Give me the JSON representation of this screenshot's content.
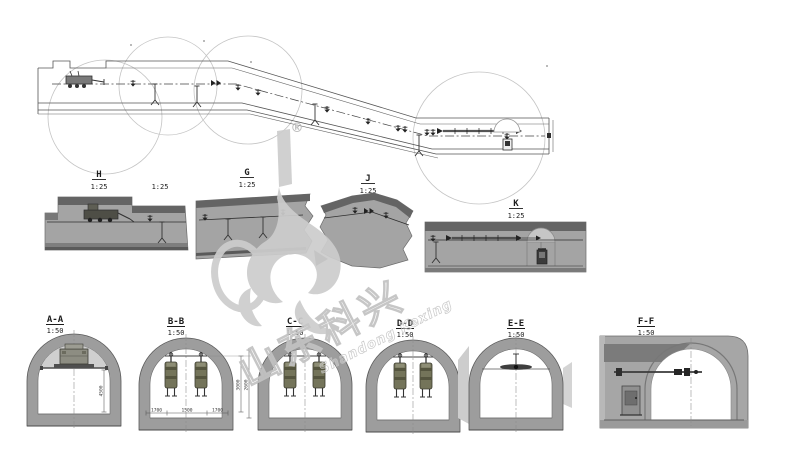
{
  "watermark": {
    "registered": "®",
    "cn": "山东科兴",
    "en": "Shandong Kexing"
  },
  "details": {
    "h": {
      "id": "H",
      "scale": "1:25"
    },
    "h_right_scale": "1:25",
    "g": {
      "id": "G",
      "scale": "1:25"
    },
    "j": {
      "id": "J",
      "scale": "1:25"
    },
    "k": {
      "id": "K",
      "scale": "1:25"
    }
  },
  "sections": {
    "aa": {
      "id": "A-A",
      "scale": "1:50",
      "dim_height": "4500"
    },
    "bb": {
      "id": "B-B",
      "scale": "1:50",
      "dim_right_inner": "3000",
      "dim_right_outer": "2600",
      "dim_bottom": [
        "1700",
        "1500",
        "1700"
      ]
    },
    "cc": {
      "id": "C-C",
      "scale": "1:50"
    },
    "dd": {
      "id": "D-D",
      "scale": "1:50"
    },
    "ee": {
      "id": "E-E",
      "scale": "1:50"
    },
    "ff": {
      "id": "F-F",
      "scale": "1:50"
    }
  },
  "colors": {
    "section_body": "#a4a4a4",
    "section_top_band": "#646464",
    "tunnel_lining": "#9d9d9d",
    "equipment_olive": "#74745a",
    "watermark_gray": "#cdcdcd"
  }
}
